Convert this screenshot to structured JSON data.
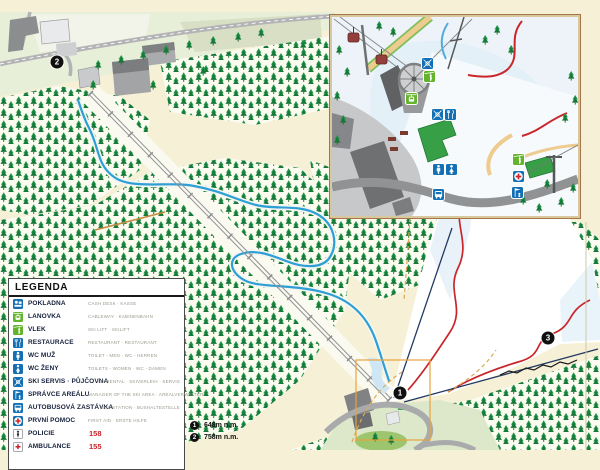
{
  "legend": {
    "title": "LEGENDA",
    "items": [
      {
        "icon": "cash-desk",
        "label": "POKLADNA",
        "sublabel": "CASH DESK · KASSE",
        "bg": "#1470B5"
      },
      {
        "icon": "cable-car",
        "label": "LANOVKA",
        "sublabel": "CABLEWAY · KABINENBAHN",
        "bg": "#64B32D"
      },
      {
        "icon": "ski-lift",
        "label": "VLEK",
        "sublabel": "SKI LIFT · SKILIFT",
        "bg": "#64B32D"
      },
      {
        "icon": "restaurant",
        "label": "RESTAURACE",
        "sublabel": "RESTAURANT · RESTAURANT",
        "bg": "#1470B5"
      },
      {
        "icon": "wc-man",
        "label": "WC MUŽ",
        "sublabel": "TOILET - MEN · WC - HERREN",
        "bg": "#1470B5"
      },
      {
        "icon": "wc-woman",
        "label": "WC ŽENY",
        "sublabel": "TOILETS - WOMEN · WC - DAMEN",
        "bg": "#1470B5"
      },
      {
        "icon": "ski-service",
        "label": "SKI SERVIS · PŮJČOVNA",
        "sublabel": "SKI RENTAL · SKIVERLEIH · SERVIS",
        "bg": "#1470B5"
      },
      {
        "icon": "area-manager",
        "label": "SPRÁVCE AREÁLU",
        "sublabel": "MANAGER OF THE SKI AREA · AREALVERWALTER",
        "bg": "#1470B5"
      },
      {
        "icon": "bus",
        "label": "AUTOBUSOVÁ ZASTÁVKA",
        "sublabel": "BUS STATION · BUSHALTESTELLE",
        "bg": "#1470B5"
      },
      {
        "icon": "first-aid",
        "label": "PRVNÍ POMOC",
        "sublabel": "FIRST AID · ERSTE HILFE",
        "bg": "#1470B5"
      },
      {
        "icon": "police",
        "label": "POLICIE",
        "number": "158",
        "bg": "#FFFFFF"
      },
      {
        "icon": "ambulance",
        "label": "AMBULANCE",
        "number": "155",
        "bg": "#FFFFFF"
      }
    ]
  },
  "altitudes": {
    "items": [
      {
        "marker": "1",
        "label": "648m n.m."
      },
      {
        "marker": "2",
        "label": "758m n.m."
      }
    ]
  },
  "map_markers": [
    {
      "number": "2",
      "x": 57,
      "y": 62
    },
    {
      "number": "1",
      "x": 400,
      "y": 393
    },
    {
      "number": "3",
      "x": 548,
      "y": 338
    }
  ],
  "inset": {
    "icons": [
      {
        "icon": "ski-service",
        "x": 90,
        "y": 41,
        "bg": "#1470B5"
      },
      {
        "icon": "ski-lift",
        "x": 92,
        "y": 54,
        "bg": "#64B32D"
      },
      {
        "icon": "cable-car",
        "x": 74,
        "y": 76,
        "bg": "#64B32D"
      },
      {
        "icon": "ski-service",
        "x": 100,
        "y": 92,
        "bg": "#1470B5"
      },
      {
        "icon": "restaurant",
        "x": 113,
        "y": 92,
        "bg": "#1470B5"
      },
      {
        "icon": "wc-man",
        "x": 101,
        "y": 147,
        "bg": "#1470B5"
      },
      {
        "icon": "wc-woman",
        "x": 114,
        "y": 147,
        "bg": "#1470B5"
      },
      {
        "icon": "bus",
        "x": 101,
        "y": 172,
        "bg": "#1470B5"
      },
      {
        "icon": "ski-lift",
        "x": 181,
        "y": 137,
        "bg": "#64B32D"
      },
      {
        "icon": "first-aid",
        "x": 181,
        "y": 154,
        "bg": "#1470B5"
      },
      {
        "icon": "area-manager",
        "x": 180,
        "y": 170,
        "bg": "#1470B5"
      }
    ]
  },
  "colors": {
    "legend_blue": "#1470B5",
    "legend_green": "#64B32D",
    "emergency_red": "#CC2229",
    "forest_green": "#1E9447",
    "river_blue": "#2E9ED6",
    "piste_red": "#C9262C",
    "background_cream": "#F6F0D6"
  }
}
